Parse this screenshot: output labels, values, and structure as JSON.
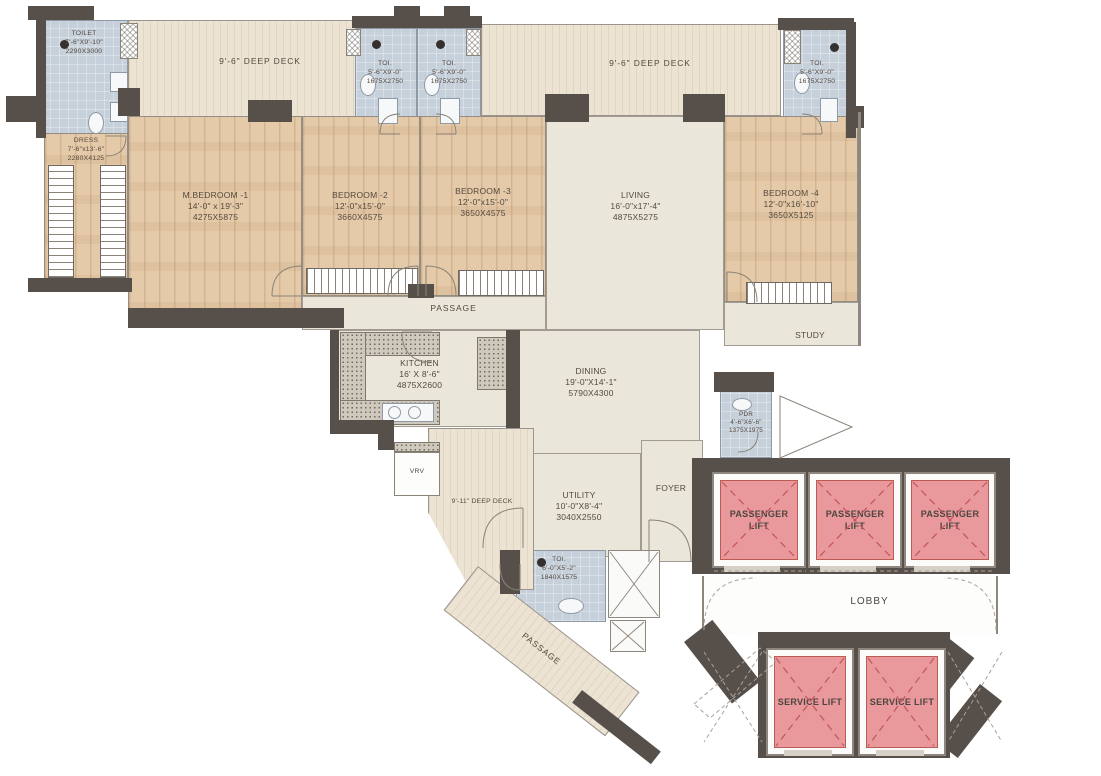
{
  "rooms": {
    "toilet_master": {
      "name": "TOILET",
      "dims": "7'-6\"X9'-10\"",
      "mm": "2290X3000"
    },
    "deck_left": {
      "name": "9'-6\" DEEP DECK"
    },
    "toi_2": {
      "name": "TOI.",
      "dims": "5'-6\"X9'-0\"",
      "mm": "1675X2750"
    },
    "toi_3": {
      "name": "TOI.",
      "dims": "5'-6\"X9'-0\"",
      "mm": "1675X2750"
    },
    "deck_right": {
      "name": "9'-6\" DEEP DECK"
    },
    "toi_4": {
      "name": "TOI.",
      "dims": "5'-6\"X9'-0\"",
      "mm": "1675X2750"
    },
    "dress": {
      "name": "DRESS",
      "dims": "7'-6\"x13'-6\"",
      "mm": "2280X4125"
    },
    "m_bedroom_1": {
      "name": "M.BEDROOM -1",
      "dims": "14'-0\" x 19'-3\"",
      "mm": "4275X5875"
    },
    "bedroom_2": {
      "name": "BEDROOM -2",
      "dims": "12'-0\"x15'-0\"",
      "mm": "3660X4575"
    },
    "bedroom_3": {
      "name": "BEDROOM -3",
      "dims": "12'-0\"x15'-0\"",
      "mm": "3650X4575"
    },
    "living": {
      "name": "LIVING",
      "dims": "16'-0\"x17'-4\"",
      "mm": "4875X5275"
    },
    "bedroom_4": {
      "name": "BEDROOM -4",
      "dims": "12'-0\"x16'-10\"",
      "mm": "3650X5125"
    },
    "study": {
      "name": "STUDY"
    },
    "passage": {
      "name": "PASSAGE"
    },
    "kitchen": {
      "name": "KITCHEN",
      "dims": "16' X 8'-6\"",
      "mm": "4875X2600"
    },
    "dining": {
      "name": "DINING",
      "dims": "19'-0\"X14'-1\"",
      "mm": "5790X4300"
    },
    "pdr": {
      "name": "PDR",
      "dims": "4'-6\"X6'-6\"",
      "mm": "1375X1975"
    },
    "vrv": {
      "name": "VRV"
    },
    "deck_bottom": {
      "name": "9'-11\" DEEP DECK"
    },
    "utility": {
      "name": "UTILITY",
      "dims": "10'-0\"X8'-4\"",
      "mm": "3040X2550"
    },
    "foyer": {
      "name": "FOYER"
    },
    "toi_utility": {
      "name": "TOI.",
      "dims": "6'-0\"X5'-2\"",
      "mm": "1840X1575"
    },
    "passage_lower": {
      "name": "PASSAGE"
    },
    "lobby": {
      "name": "LOBBY"
    },
    "passenger_lift": {
      "name": "PASSENGER LIFT"
    },
    "service_lift": {
      "name": "SERVICE LIFT"
    }
  },
  "colors": {
    "wall": "#57504a",
    "deck_floor": "#ece3d3",
    "wood_floor": "#e4caa8",
    "bath_floor": "#c6d0db",
    "lift_fill": "#e9989b",
    "lift_cross": "#c2555c",
    "label_text": "#55493f"
  }
}
